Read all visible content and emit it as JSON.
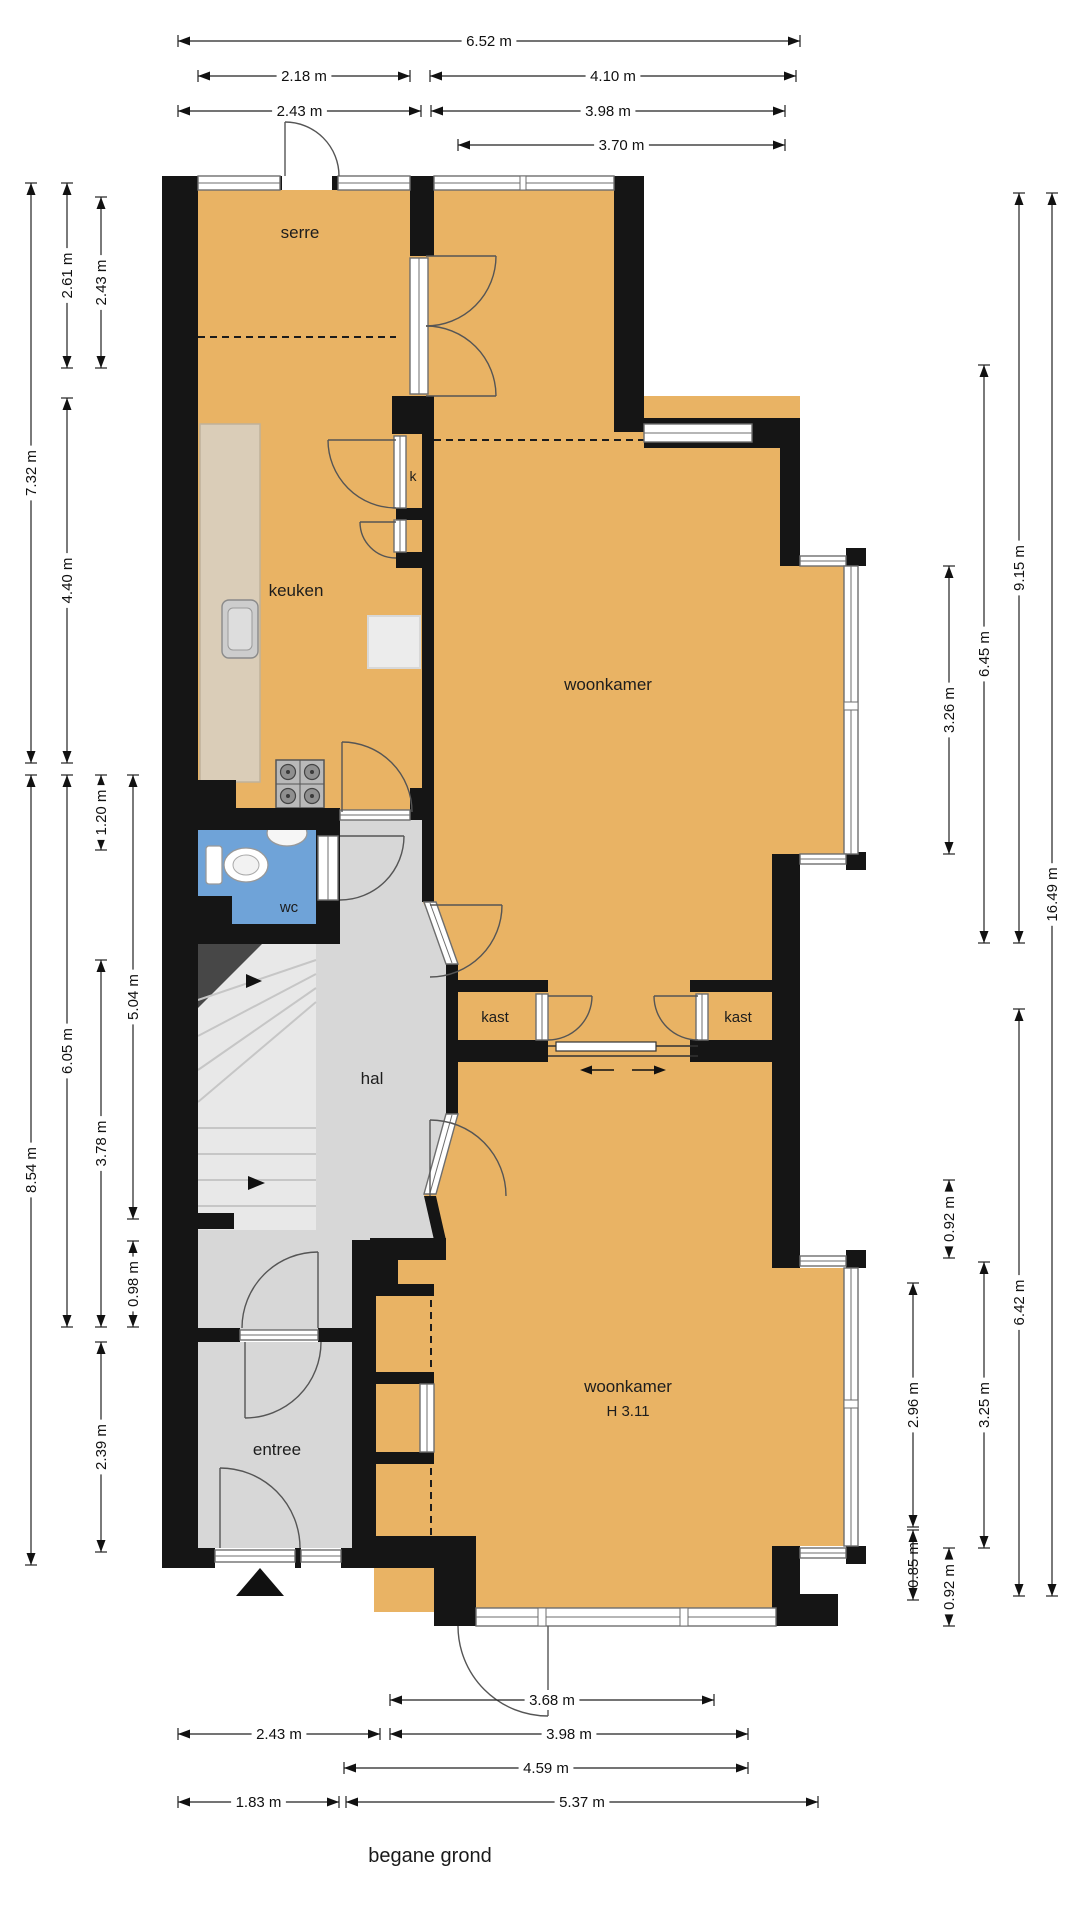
{
  "title": "begane grond",
  "colors": {
    "room_fill": "#E9B364",
    "hall_fill": "#D7D7D7",
    "wc_fill": "#6FA3D8",
    "wall": "#151515",
    "counter_fill": "#DACDB8",
    "stairs_fill": "#E8E8E8"
  },
  "rooms": [
    {
      "id": "serre",
      "label": "serre",
      "x": 300,
      "y": 238,
      "size": 17
    },
    {
      "id": "closet-k",
      "label": "k",
      "x": 413,
      "y": 481,
      "size": 14
    },
    {
      "id": "keuken",
      "label": "keuken",
      "x": 296,
      "y": 596,
      "size": 17
    },
    {
      "id": "woonkamer",
      "label": "woonkamer",
      "x": 608,
      "y": 690,
      "size": 17
    },
    {
      "id": "wc",
      "label": "wc",
      "x": 289,
      "y": 912,
      "size": 15
    },
    {
      "id": "kast-left",
      "label": "kast",
      "x": 495,
      "y": 1022,
      "size": 15
    },
    {
      "id": "kast-right",
      "label": "kast",
      "x": 738,
      "y": 1022,
      "size": 15
    },
    {
      "id": "hal",
      "label": "hal",
      "x": 372,
      "y": 1084,
      "size": 17
    },
    {
      "id": "woonkamer-2",
      "label": "woonkamer",
      "x": 628,
      "y": 1392,
      "size": 17
    },
    {
      "id": "woonkamer-2-height",
      "label": "H 3.11",
      "x": 628,
      "y": 1416,
      "size": 15
    },
    {
      "id": "entree",
      "label": "entree",
      "x": 277,
      "y": 1455,
      "size": 17
    }
  ],
  "dimensions": {
    "top": [
      {
        "label": "6.52 m",
        "x1": 178,
        "x2": 800,
        "y": 41
      },
      {
        "label": "2.18 m",
        "x1": 198,
        "x2": 410,
        "y": 76
      },
      {
        "label": "4.10 m",
        "x1": 430,
        "x2": 796,
        "y": 76
      },
      {
        "label": "2.43 m",
        "x1": 178,
        "x2": 421,
        "y": 111
      },
      {
        "label": "3.98 m",
        "x1": 431,
        "x2": 785,
        "y": 111
      },
      {
        "label": "3.70 m",
        "x1": 458,
        "x2": 785,
        "y": 145
      }
    ],
    "bottom": [
      {
        "label": "3.68 m",
        "x1": 390,
        "x2": 714,
        "y": 1700
      },
      {
        "label": "2.43 m",
        "x1": 178,
        "x2": 380,
        "y": 1734
      },
      {
        "label": "3.98 m",
        "x1": 390,
        "x2": 748,
        "y": 1734
      },
      {
        "label": "4.59 m",
        "x1": 344,
        "x2": 748,
        "y": 1768
      },
      {
        "label": "1.83 m",
        "x1": 178,
        "x2": 339,
        "y": 1802
      },
      {
        "label": "5.37 m",
        "x1": 346,
        "x2": 818,
        "y": 1802
      }
    ],
    "left": [
      {
        "label": "7.32 m",
        "x": 31,
        "y1": 183,
        "y2": 763
      },
      {
        "label": "8.54 m",
        "x": 31,
        "y1": 775,
        "y2": 1565
      },
      {
        "label": "2.61 m",
        "x": 67,
        "y1": 183,
        "y2": 368
      },
      {
        "label": "4.40 m",
        "x": 67,
        "y1": 398,
        "y2": 763
      },
      {
        "label": "6.05 m",
        "x": 67,
        "y1": 775,
        "y2": 1327
      },
      {
        "label": "2.43 m",
        "x": 101,
        "y1": 197,
        "y2": 368
      },
      {
        "label": "1.20 m",
        "x": 101,
        "y1": 775,
        "y2": 850
      },
      {
        "label": "3.78 m",
        "x": 101,
        "y1": 960,
        "y2": 1327
      },
      {
        "label": "2.39 m",
        "x": 101,
        "y1": 1342,
        "y2": 1552
      },
      {
        "label": "5.04 m",
        "x": 133,
        "y1": 775,
        "y2": 1219
      },
      {
        "label": "0.98 m",
        "x": 133,
        "y1": 1241,
        "y2": 1327
      }
    ],
    "right": [
      {
        "label": "2.96 m",
        "x": 913,
        "y1": 1283,
        "y2": 1527
      },
      {
        "label": "0.85 m",
        "x": 913,
        "y1": 1530,
        "y2": 1600
      },
      {
        "label": "3.26 m",
        "x": 949,
        "y1": 566,
        "y2": 854
      },
      {
        "label": "0.92 m",
        "x": 949,
        "y1": 1180,
        "y2": 1258
      },
      {
        "label": "0.92 m",
        "x": 949,
        "y1": 1548,
        "y2": 1626
      },
      {
        "label": "6.45 m",
        "x": 984,
        "y1": 365,
        "y2": 943
      },
      {
        "label": "3.25 m",
        "x": 984,
        "y1": 1262,
        "y2": 1548
      },
      {
        "label": "9.15 m",
        "x": 1019,
        "y1": 193,
        "y2": 943
      },
      {
        "label": "6.42 m",
        "x": 1019,
        "y1": 1009,
        "y2": 1596
      },
      {
        "label": "16.49 m",
        "x": 1052,
        "y1": 193,
        "y2": 1596
      }
    ]
  }
}
